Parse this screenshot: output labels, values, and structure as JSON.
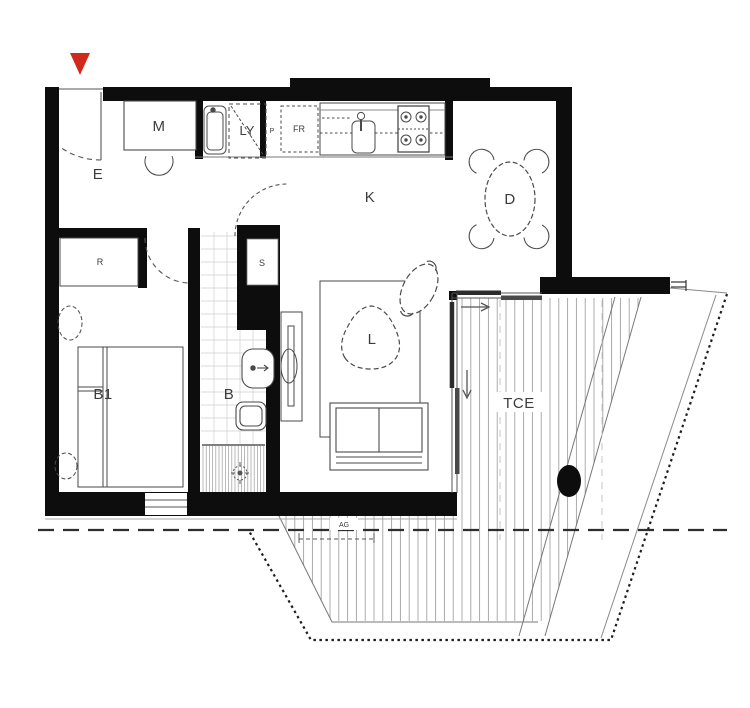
{
  "title": "Apartment floor plan",
  "colors": {
    "wall": "#0d0d0d",
    "line": "#4a4a4a",
    "light_line": "#a3a3a3",
    "marker_red": "#cf2a1b",
    "label": "#3c3c3c"
  },
  "labels": {
    "entry": "E",
    "study_desk": "M",
    "laundry": "LY",
    "pantry": "P",
    "fridge": "FR",
    "kitchen": "K",
    "dining": "D",
    "robe": "R",
    "storage": "S",
    "bathroom": "B",
    "bedroom1": "B1",
    "living": "L",
    "terrace": "TCE",
    "annotation": "AG"
  }
}
